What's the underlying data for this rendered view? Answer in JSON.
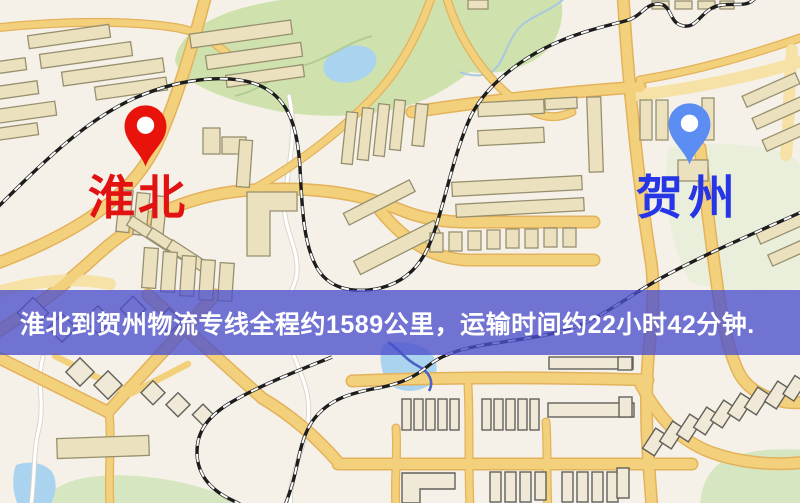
{
  "map": {
    "origin": {
      "label": "淮北",
      "label_color": "#e21212",
      "marker_color": "#e8130a"
    },
    "destination": {
      "label": "贺州",
      "label_color": "#2635e6",
      "marker_color": "#5b8df2"
    },
    "banner": {
      "text": "淮北到贺州物流专线全程约1589公里，运输时间约22小时42分钟.",
      "background": "#4c50cd",
      "text_color": "#ffffff"
    },
    "route_facts": {
      "distance_km": "1589",
      "duration": "22小时42分钟"
    }
  }
}
